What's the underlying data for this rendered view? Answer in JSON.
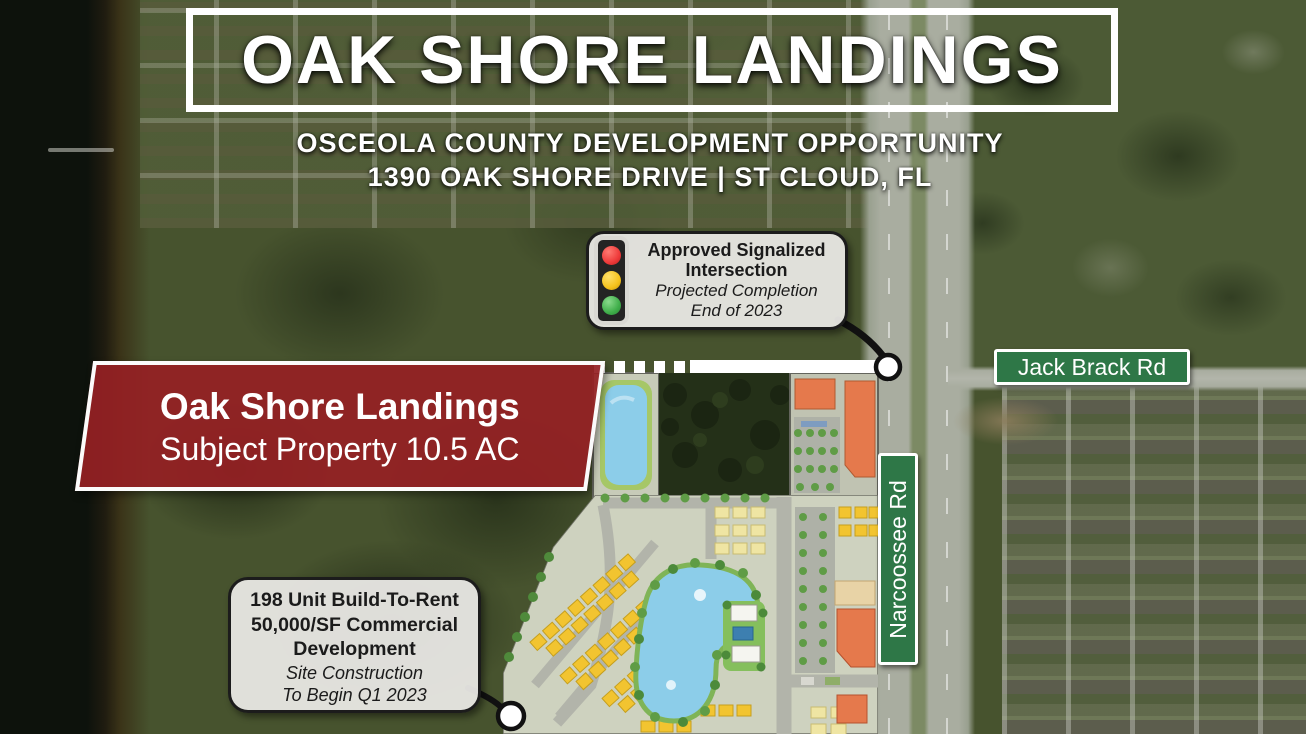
{
  "flyer": {
    "title": "OAK SHORE LANDINGS",
    "subtitle_line1": "OSCEOLA COUNTY DEVELOPMENT OPPORTUNITY",
    "subtitle_line2": "1390 OAK SHORE DRIVE | ST CLOUD, FL"
  },
  "signal_callout": {
    "icon": "traffic-light-icon",
    "line1_bold": "Approved Signalized",
    "line2_bold": "Intersection",
    "line3_italic": "Projected Completion",
    "line4_italic": "End of 2023",
    "light_colors": {
      "top": "#ee3a3a",
      "middle": "#f6c31d",
      "bottom": "#3fae4a"
    }
  },
  "subject_banner": {
    "line1": "Oak Shore Landings",
    "line2": "Subject Property 10.5 AC",
    "background": "#942024"
  },
  "dev_callout": {
    "line1_bold": "198 Unit Build-To-Rent",
    "line2_bold": "50,000/SF Commercial",
    "line3_bold": "Development",
    "line4_italic": "Site Construction",
    "line5_italic": "To Begin Q1 2023"
  },
  "street_signs": {
    "horizontal": {
      "label": "Jack Brack Rd",
      "background": "#2e7747"
    },
    "vertical": {
      "label": "Narcoossee Rd",
      "background": "#2e7747"
    }
  },
  "site_plan_colors": {
    "residential_unit": "#f2c430",
    "pale_unit": "#efe5a3",
    "commercial_building": "#e5794c",
    "pond": "#8ccde9",
    "road": "#b2b4aa",
    "tree": "#5f9c46"
  }
}
